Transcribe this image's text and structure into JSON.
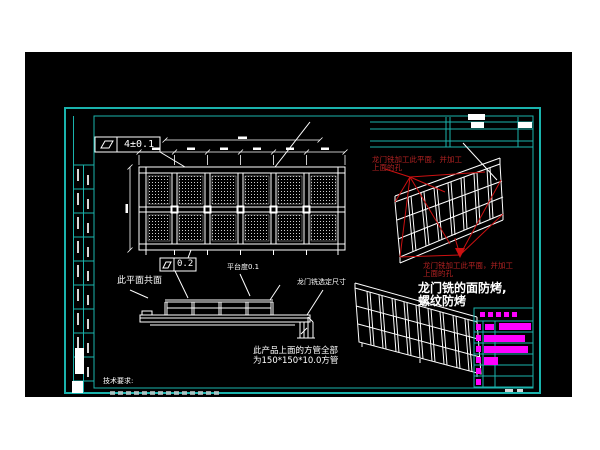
{
  "colors": {
    "page_bg": "#ffffff",
    "canvas_bg": "#000000",
    "frame_cyan": "#1ab3ad",
    "linework_white": "#ffffff",
    "annotation_red": "#b32222",
    "highlight_magenta": "#ff00ff"
  },
  "annotations": {
    "fcf_top": "4±0.1",
    "fcf_mid": "0.2",
    "coplanar_note": "此平面共面",
    "platform_note": "平台度0.1",
    "gantry_note": "龙门铣选定尺寸",
    "red_note_top_line1": "龙门铣加工此平面，并加工",
    "red_note_top_line2": "上面的孔",
    "red_note_bottom_line1": "龙门铣加工此平面，并加工",
    "red_note_bottom_line2": "上面的孔",
    "antibake_line1": "龙门铣的面防烤,",
    "antibake_line2": "螺纹防烤",
    "tube_note_line1": "此产品上面的方管全部",
    "tube_note_line2": "为150*150*10.0方管",
    "tech_req_title": "技术要求:"
  }
}
